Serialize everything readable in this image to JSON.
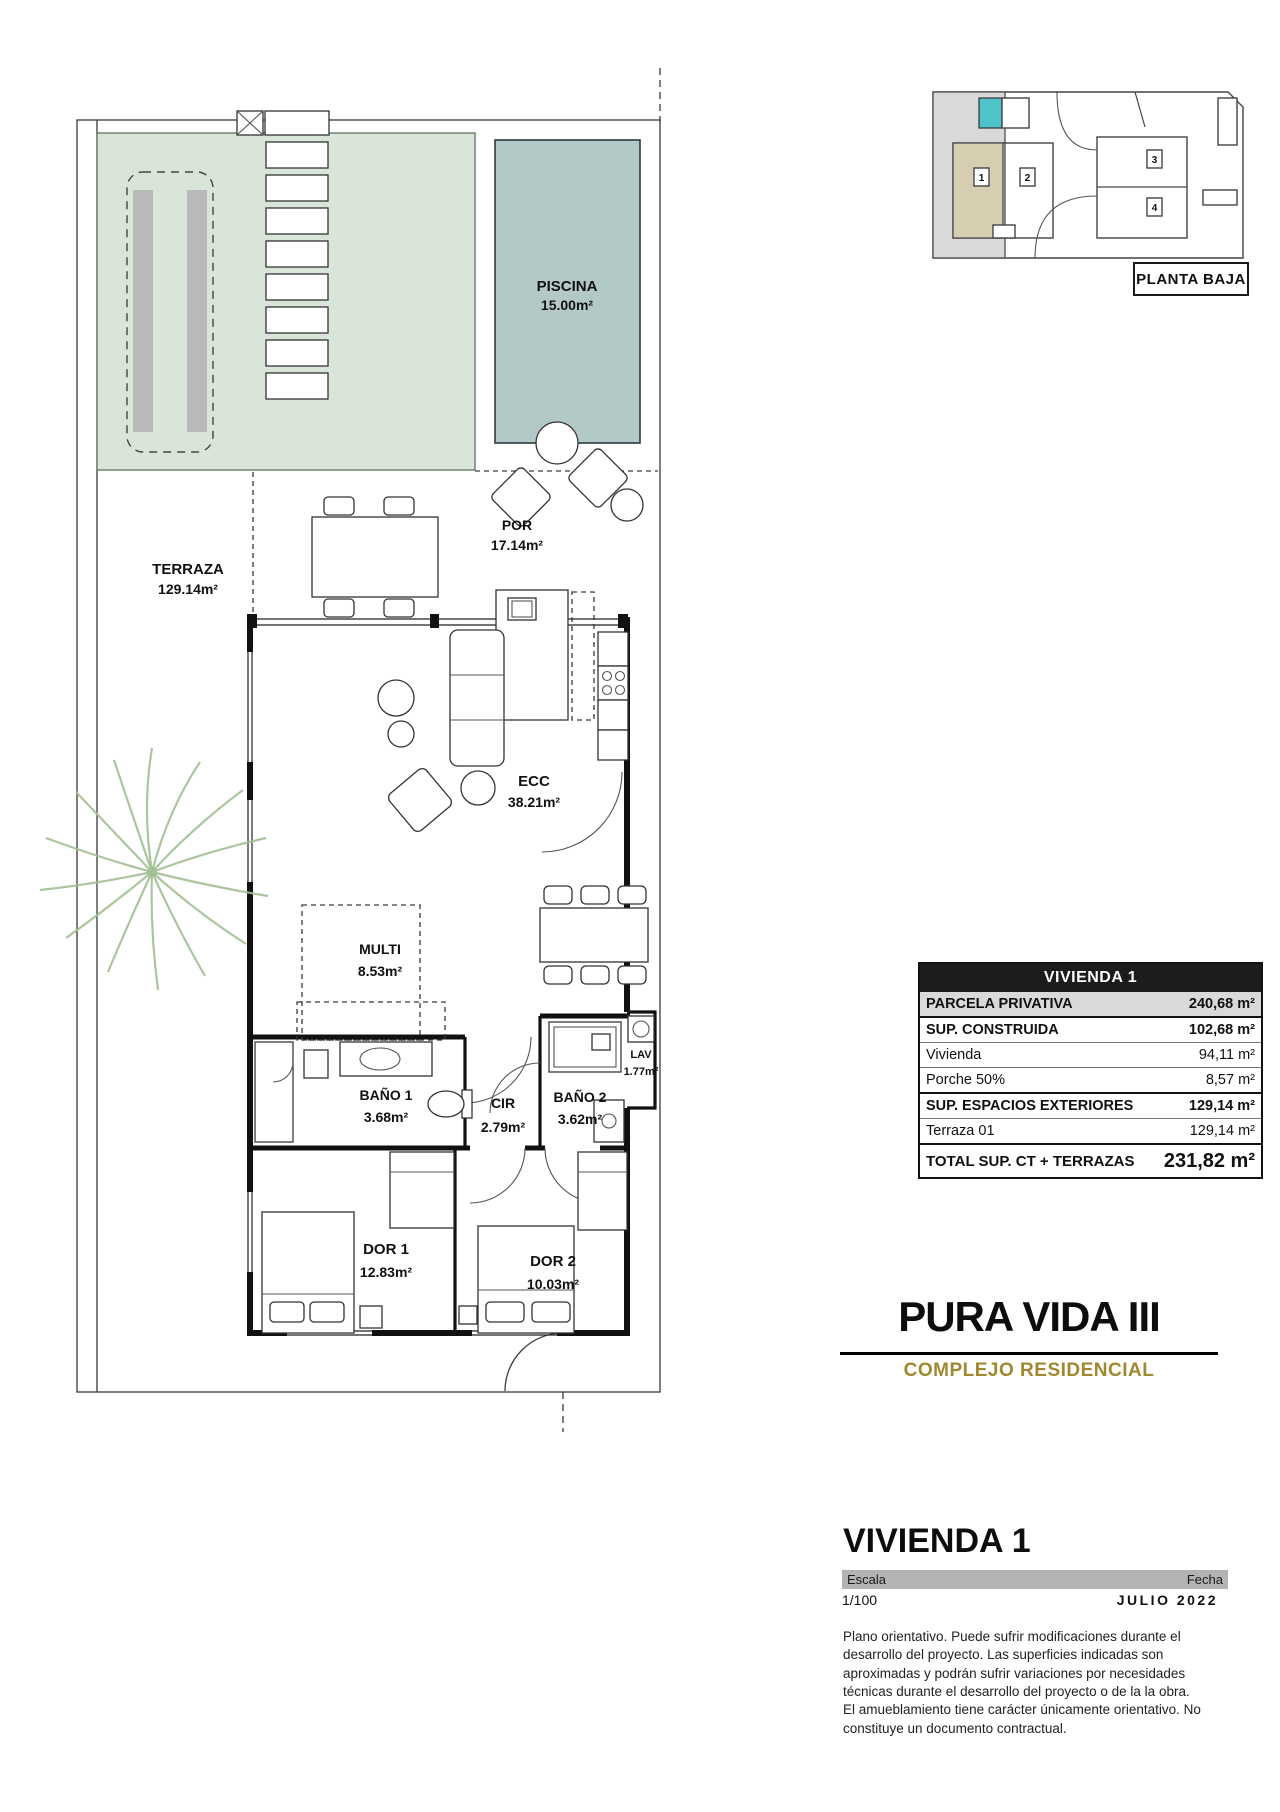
{
  "site_key": {
    "label": "PLANTA BAJA",
    "units": [
      "1",
      "2",
      "3",
      "4"
    ],
    "colors": {
      "highlight_unit": "#d7ceb2",
      "pool": "#4fc3c9",
      "side_band": "#d9d9d9"
    }
  },
  "floor_plan": {
    "rooms": [
      {
        "id": "piscina",
        "name": "PISCINA",
        "area": "15.00m²"
      },
      {
        "id": "terraza",
        "name": "TERRAZA",
        "area": "129.14m²"
      },
      {
        "id": "por",
        "name": "POR",
        "area": "17.14m²"
      },
      {
        "id": "ecc",
        "name": "ECC",
        "area": "38.21m²"
      },
      {
        "id": "multi",
        "name": "MULTI",
        "area": "8.53m²"
      },
      {
        "id": "bano1",
        "name": "BAÑO 1",
        "area": "3.68m²"
      },
      {
        "id": "cir",
        "name": "CIR",
        "area": "2.79m²"
      },
      {
        "id": "bano2",
        "name": "BAÑO 2",
        "area": "3.62m²"
      },
      {
        "id": "lav",
        "name": "LAV",
        "area": "1.77m²"
      },
      {
        "id": "dor1",
        "name": "DOR 1",
        "area": "12.83m²"
      },
      {
        "id": "dor2",
        "name": "DOR 2",
        "area": "10.03m²"
      }
    ],
    "colors": {
      "garden_green": "#d9e5d8",
      "pool_water": "#b2c9c8"
    }
  },
  "summary_table": {
    "header": "VIVIENDA 1",
    "rows": [
      {
        "label": "PARCELA PRIVATIVA",
        "value": "240,68 m²"
      },
      {
        "label": "SUP. CONSTRUIDA",
        "value": "102,68 m²"
      },
      {
        "label": "Vivienda",
        "value": "94,11 m²"
      },
      {
        "label": "Porche  50%",
        "value": "8,57 m²"
      },
      {
        "label": "SUP. ESPACIOS EXTERIORES",
        "value": "129,14 m²"
      },
      {
        "label": "Terraza 01",
        "value": "129,14 m²"
      },
      {
        "label": "TOTAL SUP. CT + TERRAZAS",
        "value": "231,82 m²"
      }
    ]
  },
  "branding": {
    "project": "PURA VIDA III",
    "subtitle": "COMPLEJO RESIDENCIAL",
    "accent_color": "#a1872f"
  },
  "sheet": {
    "title": "VIVIENDA 1",
    "scale_label": "Escala",
    "scale_value": "1/100",
    "date_label": "Fecha",
    "date_value": "JULIO 2022",
    "disclaimer1": "Plano orientativo. Puede sufrir modificaciones durante el desarrollo del proyecto. Las superficies indicadas son aproximadas y podrán sufrir variaciones por necesidades técnicas durante el desarrollo del proyecto o de la la obra.",
    "disclaimer2": "El amueblamiento tiene carácter únicamente orientativo. No constituye un documento contractual."
  }
}
